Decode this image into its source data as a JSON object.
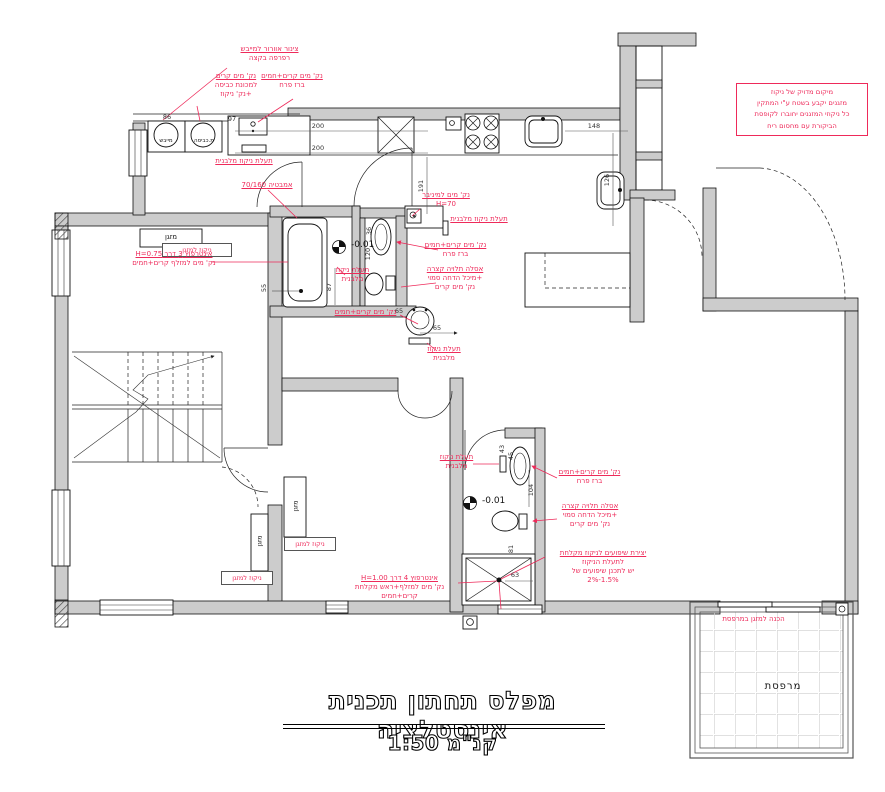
{
  "colors": {
    "annotation": "#ee2a5a",
    "wall_fill": "#cccccc",
    "line": "#1a1a1a"
  },
  "title": {
    "main": "מפלס תחתון תכנית אינסטלציה",
    "scale": "קנ\"מ 1:50"
  },
  "note_box": {
    "l1": "מיקום מדויק של ניקוז",
    "l2": "מזגנים יקבע בשטח ע\"י המתקין",
    "l3": "כל ניקוזי המזגנים יחוברו לקופסת",
    "l4": "הביקורת עם מחסום ריח"
  },
  "annotations": {
    "vent_dryer": {
      "l1": "צינור אוורור למייבש",
      "l2": "רפרפה בקצה"
    },
    "washer_point": {
      "l1": "נק' מים קרים",
      "l2": "למכונת כביסה",
      "l3": "+נק' ניקוז"
    },
    "kitchen_tap": {
      "l1": "נק' מים קרים+חמים",
      "l2": "ברז פרח"
    },
    "channel_washer": {
      "l1": "תעלת ניקוז מלבנית"
    },
    "bathtub": {
      "l1": "אמבטיה 70/160"
    },
    "ac_drain_tub": {
      "l1": "ניקוז למזגן"
    },
    "interpuz3": {
      "l1": "אינטרפוץ 3 דרך H=0.75",
      "l2": "נק' מים למזלף קרים+חמים"
    },
    "channel_tub": {
      "l1": "תעלת ניקוז",
      "l2": "מלבנית"
    },
    "minibar": {
      "l1": "נק' מים למיניבר",
      "l2": "H=70"
    },
    "channel_wc": {
      "l1": "תעלת ניקוז מלבנית"
    },
    "tap_wc": {
      "l1": "נק' מים קרים+חמים",
      "l2": "ברז פרח"
    },
    "toilet_wc": {
      "l1": "אסלה תלויה קצרה",
      "l2": "+מיכל הדחה סמוי",
      "l3": "נק' מים קרים"
    },
    "sink_point": {
      "l1": "נק' מים קרים+חמים"
    },
    "channel_sink": {
      "l1": "תעלת ניקוז",
      "l2": "מלבנית"
    },
    "tap_bath2": {
      "l1": "נק' מים קרים+חמים",
      "l2": "ברז פרח"
    },
    "toilet_bath2": {
      "l1": "אסלה תלויה קצרה",
      "l2": "+מיכל הדחה סמוי",
      "l3": "נק' מים קרים"
    },
    "channel_bath2": {
      "l1": "תעלת ניקוז",
      "l2": "מלבנית"
    },
    "slopes": {
      "l1": "יצירת שיפועים לניקוז מקלחת",
      "l2": "לתעלת הניקוז",
      "l3": "יש לתכנן שיפועים של",
      "l4": "1.5%-2%"
    },
    "interpuz4": {
      "l1": "אינטרפוץ 4 דרך H=1.00",
      "l2": "נק' מים למזלף+ראש מקלחת",
      "l3": "קרים+חמים"
    },
    "ac_drain_bl1": {
      "l1": "ניקוז למזגן"
    },
    "ac_drain_bl2": {
      "l1": "ניקוז למזגן"
    },
    "terrace_ac": {
      "l1": "הכנה למזגן במרפסת"
    }
  },
  "labels": {
    "dryer": "מייבש",
    "washer": "מ.כביסה",
    "ac_unit_top": "מזגן",
    "ac_unit_left": "מזגן",
    "ac_unit_right": "מזגן",
    "terrace": "מרפסת",
    "level_a": "-0.01",
    "level_b": "-0.01"
  },
  "dims": {
    "d86": "86",
    "d97": "97",
    "d200a": "200",
    "d200b": "200",
    "d148": "148",
    "d126": "126",
    "d191": "191",
    "d87": "87",
    "d55": "55",
    "d36": "36",
    "d120": "120",
    "d65a": "65",
    "d65b": "65",
    "d43": "43",
    "d45": "45",
    "d104": "104",
    "d81": "81",
    "d63": "63"
  }
}
